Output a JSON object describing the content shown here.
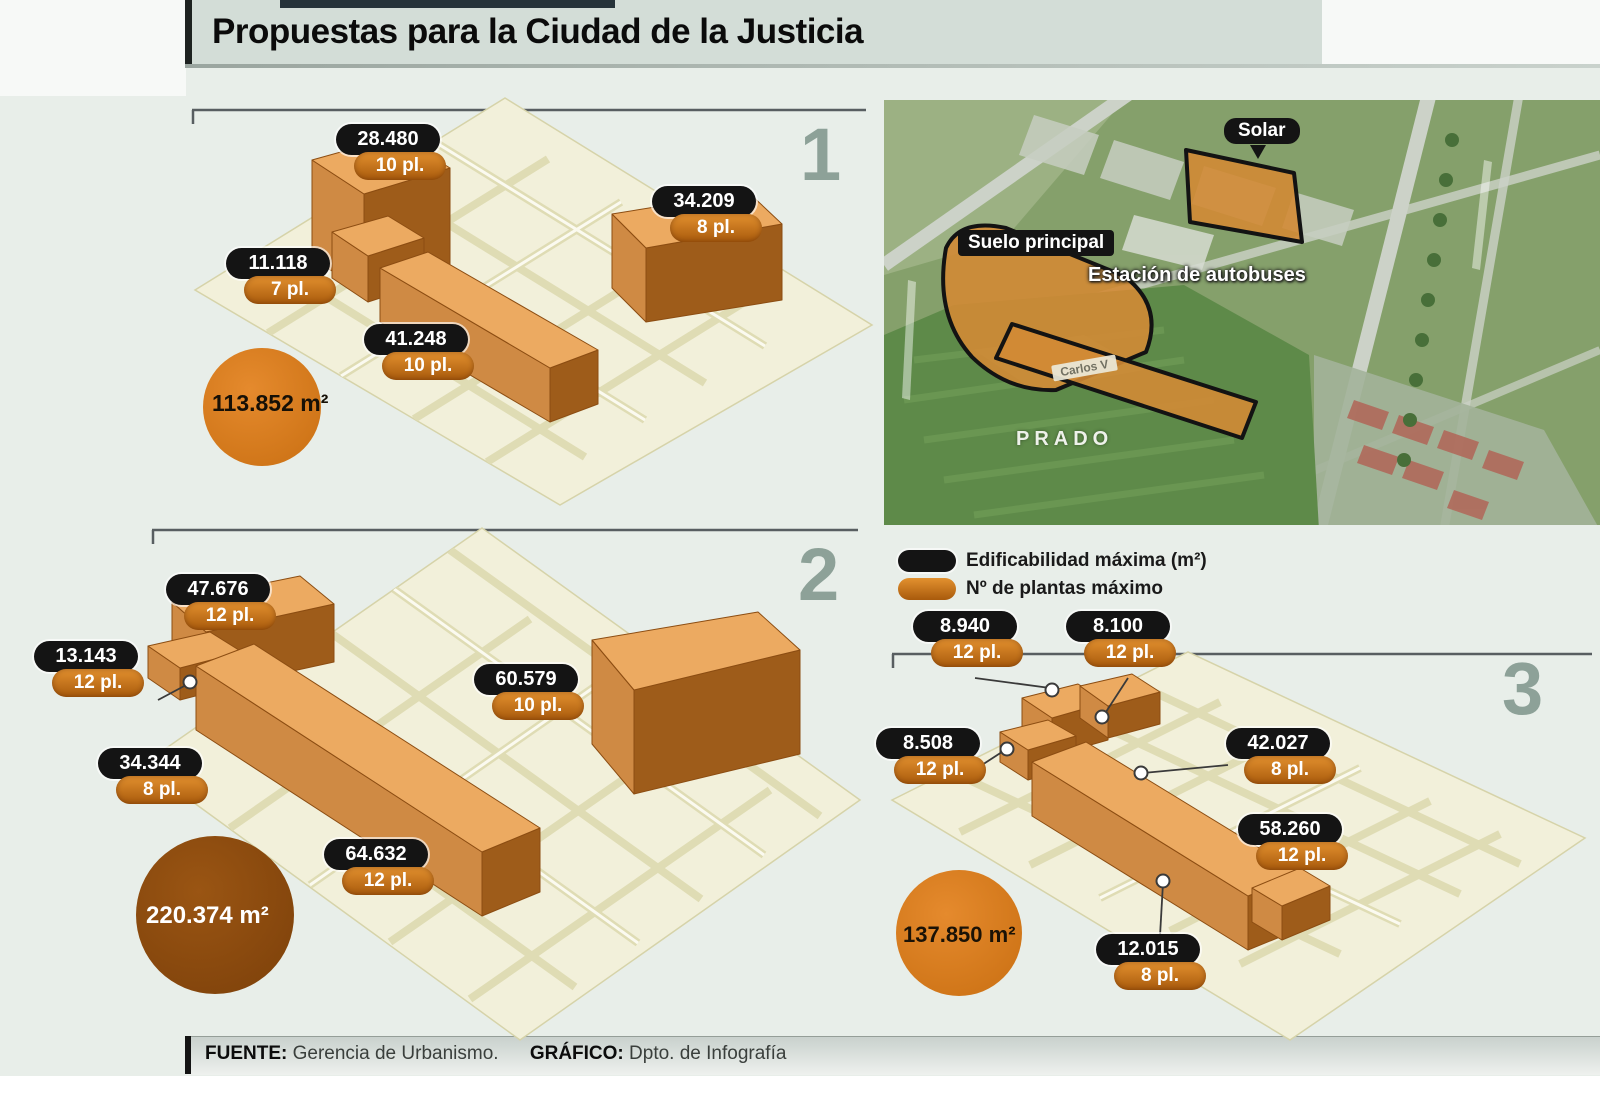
{
  "header": {
    "title": "Propuestas para la Ciudad de la Justicia"
  },
  "legend": {
    "edificabilidad": "Edificabilidad máxima (m²)",
    "plantas": "Nº de plantas máximo"
  },
  "satellite": {
    "solar": "Solar",
    "suelo_principal": "Suelo principal",
    "estacion": "Estación de autobuses",
    "prado": "PRADO",
    "road_label": "Carlos V"
  },
  "panels": [
    {
      "number": "1",
      "total": "113.852 m²",
      "buildings": [
        {
          "area": "28.480",
          "floors": "10 pl."
        },
        {
          "area": "34.209",
          "floors": "8 pl."
        },
        {
          "area": "11.118",
          "floors": "7 pl."
        },
        {
          "area": "41.248",
          "floors": "10 pl."
        }
      ]
    },
    {
      "number": "2",
      "total": "220.374 m²",
      "buildings": [
        {
          "area": "47.676",
          "floors": "12 pl."
        },
        {
          "area": "13.143",
          "floors": "12 pl."
        },
        {
          "area": "34.344",
          "floors": "8 pl."
        },
        {
          "area": "60.579",
          "floors": "10 pl."
        },
        {
          "area": "64.632",
          "floors": "12 pl."
        }
      ]
    },
    {
      "number": "3",
      "total": "137.850 m²",
      "buildings": [
        {
          "area": "8.940",
          "floors": "12 pl."
        },
        {
          "area": "8.100",
          "floors": "12 pl."
        },
        {
          "area": "8.508",
          "floors": "12 pl."
        },
        {
          "area": "42.027",
          "floors": "8 pl."
        },
        {
          "area": "58.260",
          "floors": "12 pl."
        },
        {
          "area": "12.015",
          "floors": "8 pl."
        }
      ]
    }
  ],
  "footer": {
    "fuente_label": "FUENTE:",
    "fuente_value": " Gerencia de Urbanismo.",
    "grafico_label": "GRÁFICO:",
    "grafico_value": " Dpto. de Infografía"
  },
  "colors": {
    "accent_orange": "#d97b1e",
    "pill_black": "#141414",
    "circle_dark": "#8a4b10",
    "map_cream": "#f2f0da"
  }
}
